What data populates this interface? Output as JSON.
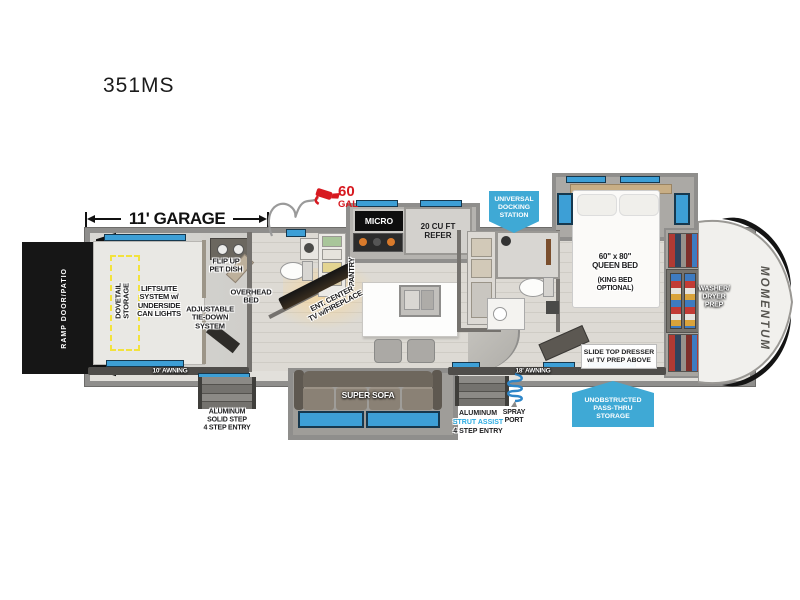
{
  "title": "351MS",
  "brand": "MOMENTUM",
  "fuel": {
    "amount": "60",
    "unit": "GAL"
  },
  "garage": {
    "dimension": "11' GARAGE",
    "ramp_door": "RAMP DOOR/PATIO",
    "dovetail": "DOVETAIL\nSTORAGE",
    "liftsuite": "LIFTSUITE\nSYSTEM w/\nUNDERSIDE\nCAN LIGHTS",
    "pet_dish": "FLIP UP\nPET DISH",
    "overhead_bed": "OVERHEAD\nBED",
    "tie_down": "ADJUSTABLE\nTIE-DOWN\nSYSTEM",
    "awning": "10' AWNING",
    "entry_step": "ALUMINUM\nSOLID STEP\n4 STEP ENTRY"
  },
  "kitchen": {
    "micro": "MICRO",
    "refer": "20 CU FT\nREFER",
    "pantry": "PANTRY"
  },
  "living": {
    "ent_center": "ENT. CENTER\nTV w/FIREPLACE",
    "sofa": "SUPER SOFA",
    "awning": "18' AWNING"
  },
  "bath": {
    "docking": "UNIVERSAL\nDOCKING\nSTATION"
  },
  "entry": {
    "step_line1": "ALUMINUM",
    "step_line2": "STRUT ASSIST",
    "step_line3": "4 STEP ENTRY",
    "spray": "SPRAY\nPORT"
  },
  "storage": {
    "pass_thru": "UNOBSTRUCTED\nPASS-THRU\nSTORAGE"
  },
  "bedroom": {
    "bed": "60\" x 80\"\nQUEEN BED",
    "bed_option": "(KING BED\nOPTIONAL)",
    "dresser": "SLIDE TOP DRESSER\nw/ TV PREP ABOVE",
    "washer_dryer": "WASHER/\nDRYER\nPREP"
  },
  "colors": {
    "badge_blue": "#3FA9D5",
    "accent_red": "#D71920",
    "strut_assist_blue": "#29ABE2",
    "window_blue": "#3D9FD6",
    "awning_gray": "#4F4D4A",
    "dovetail_yellow": "#F2E23C"
  }
}
